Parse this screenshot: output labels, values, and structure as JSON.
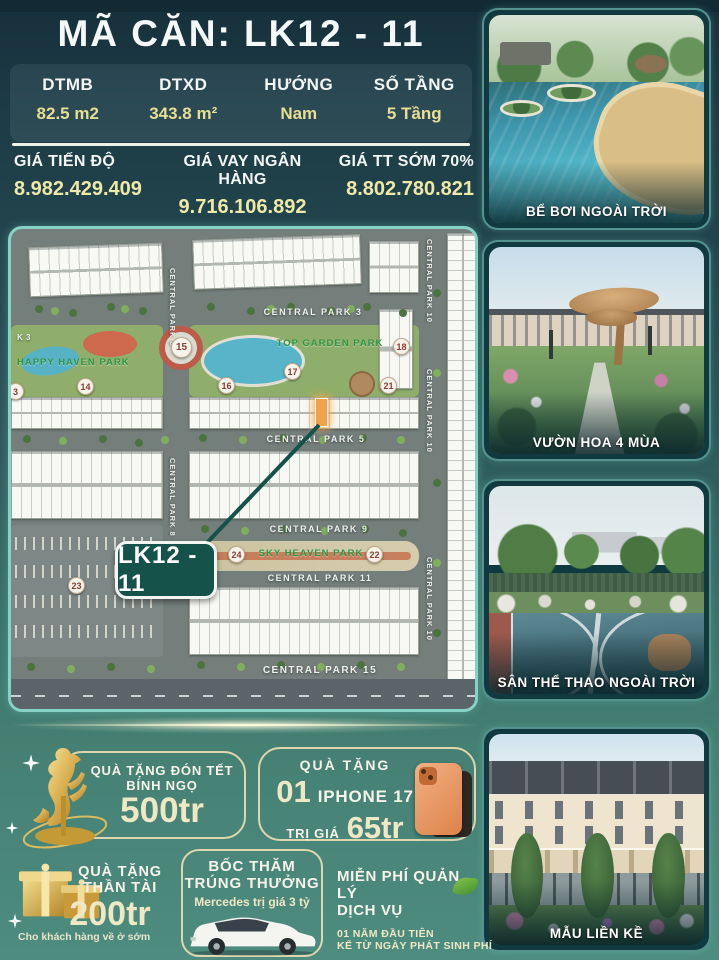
{
  "header": {
    "title": "MÃ CĂN: LK12 - 11"
  },
  "specs": [
    {
      "label": "DTMB",
      "value": "82.5 m2"
    },
    {
      "label": "DTXD",
      "value": "343.8 m²"
    },
    {
      "label": "HƯỚNG",
      "value": "Nam"
    },
    {
      "label": "SỐ TẦNG",
      "value": "5 Tầng"
    }
  ],
  "prices": [
    {
      "label": "GIÁ TIẾN ĐỘ",
      "value": "8.982.429.409"
    },
    {
      "label": "GIÁ VAY NGÂN HÀNG",
      "value": "9.716.106.892"
    },
    {
      "label": "GIÁ TT SỚM 70%",
      "value": "8.802.780.821"
    }
  ],
  "map": {
    "callout": "LK12 - 11",
    "parks": {
      "happy": "HAPPY HAVEN PARK",
      "top": "TOP GARDEN PARK",
      "sky": "SKY HEAVEN PARK"
    },
    "streets": {
      "cp3": "CENTRAL PARK 3",
      "cp5": "CENTRAL PARK 5",
      "cp8": "CENTRAL PARK 8",
      "cp9": "CENTRAL PARK 9",
      "cp10": "CENTRAL PARK 10",
      "cp11": "CENTRAL PARK 11",
      "cp15": "CENTRAL PARK 15",
      "k3": "K 3"
    },
    "markers": {
      "m3": "3",
      "m14": "14",
      "m15": "15",
      "m16": "16",
      "m17": "17",
      "m18": "18",
      "m21": "21",
      "m22": "22",
      "m23": "23",
      "m24": "24"
    }
  },
  "sidebar": {
    "cards": [
      {
        "caption": "BỂ BƠI NGOÀI TRỜI"
      },
      {
        "caption": "VƯỜN HOA 4 MÙA"
      },
      {
        "caption": "SÂN THỂ THAO NGOÀI TRỜI"
      },
      {
        "caption": "MẪU LIỀN KỀ"
      }
    ]
  },
  "promos": {
    "tet": {
      "line1": "QUÀ TẶNG ĐÓN TẾT",
      "line2": "BÍNH NGỌ",
      "amount": "500tr"
    },
    "iphone": {
      "title": "QUÀ TẶNG",
      "qty": "01",
      "product": "IPHONE 17",
      "price_label": "TRỊ GIÁ",
      "amount": "65tr"
    },
    "than_tai": {
      "line1": "QUÀ TẶNG",
      "line2": "THẦN TÀI",
      "amount": "200tr",
      "note": "Cho khách hàng về ở sớm"
    },
    "mercedes": {
      "line1": "BỐC THĂM",
      "line2": "TRÚNG THƯỞNG",
      "detail": "Mercedes trị giá 3 tỷ"
    },
    "mien_phi": {
      "line1": "MIỄN PHÍ QUẢN LÝ",
      "line2": "DỊCH VỤ",
      "detail1": "01 NĂM ĐẦU TIÊN",
      "detail2": "KỂ TỪ NGÀY PHÁT SINH PHÍ"
    }
  },
  "colors": {
    "accent_yellow": "#e6df94",
    "price_yellow": "#eee9a8",
    "bg_top": "#16303b",
    "bg_bottom": "#4e8c80",
    "map_border": "#86d2c5",
    "highlight_unit": "#f2a24c",
    "callout_bg": "#14524a",
    "promo_border": "#ddd6ae"
  }
}
